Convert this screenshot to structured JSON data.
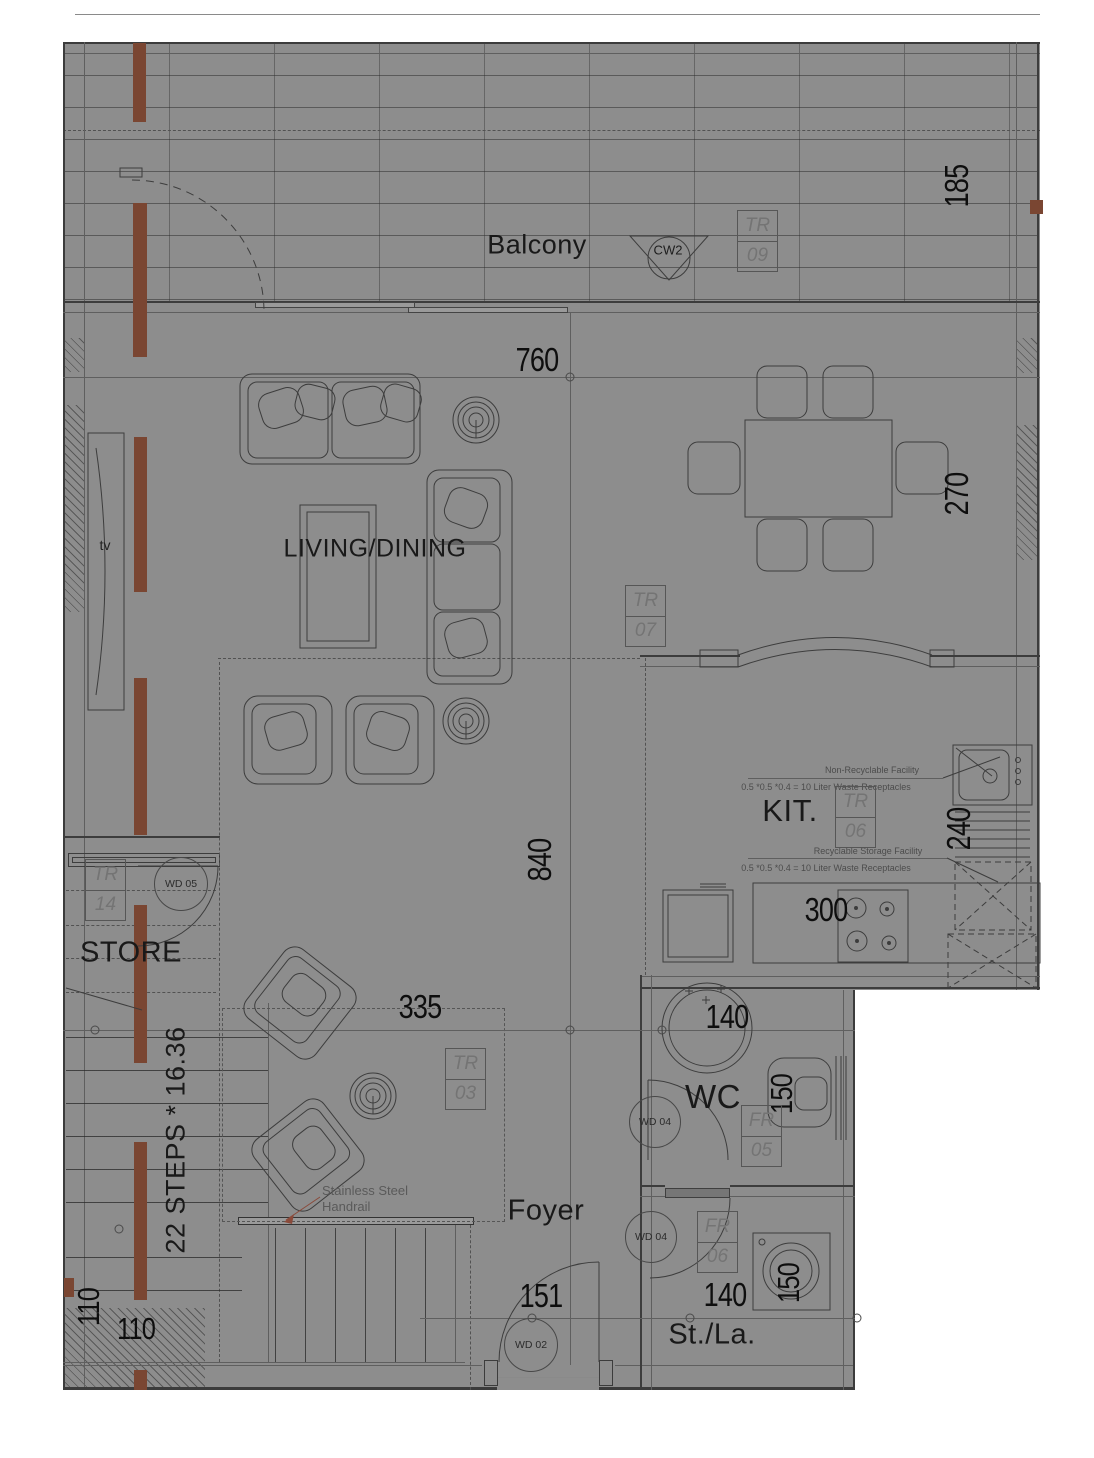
{
  "colors": {
    "plan_bg": "#8d8d8d",
    "line": "#3c3c3c",
    "accent_brown": "#7a4632",
    "leader_red": "#8a4a3a",
    "text_dark": "#141414"
  },
  "rooms": {
    "balcony": "Balcony",
    "living_dining": "LIVING/DINING",
    "kitchen": "KIT.",
    "store": "STORE",
    "wc": "WC",
    "foyer": "Foyer",
    "storage_laundry": "St./La."
  },
  "annotations": {
    "tv": "tv",
    "stairs": "22 STEPS * 16.36",
    "handrail_1": "Stainless  Steel",
    "handrail_2": "Handrail",
    "non_recyclable_title": "Non-Recyclable Facility",
    "non_recyclable_spec": "0.5 *0.5 *0.4 = 10 Liter Waste Receptacles",
    "recyclable_title": "Recyclable Storage Facility",
    "recyclable_spec": "0.5 *0.5 *0.4 = 10 Liter Waste Receptacles"
  },
  "dimensions": {
    "balcony_width": "760",
    "balcony_depth": "185",
    "living_height": "840",
    "living_width": "335",
    "dining_width": "270",
    "counter_depth": "240",
    "stove_width": "300",
    "wc_width": "140",
    "wc_depth": "150",
    "stla_width": "140",
    "stla_depth": "150",
    "entry_width": "151",
    "stair_width_v": "110",
    "stair_width_h": "110"
  },
  "tags": {
    "tr09": {
      "code": "TR",
      "num": "09"
    },
    "tr07": {
      "code": "TR",
      "num": "07"
    },
    "tr06": {
      "code": "TR",
      "num": "06"
    },
    "tr03": {
      "code": "TR",
      "num": "03"
    },
    "tr14": {
      "code": "TR",
      "num": "14"
    },
    "fr05": {
      "code": "FR",
      "num": "05"
    },
    "fr06": {
      "code": "FR",
      "num": "06"
    }
  },
  "openings": {
    "cw2": "CW2",
    "wd05": "WD 05",
    "wd04_wc": "WD 04",
    "wd04_stla": "WD 04",
    "wd02": "WD 02"
  }
}
